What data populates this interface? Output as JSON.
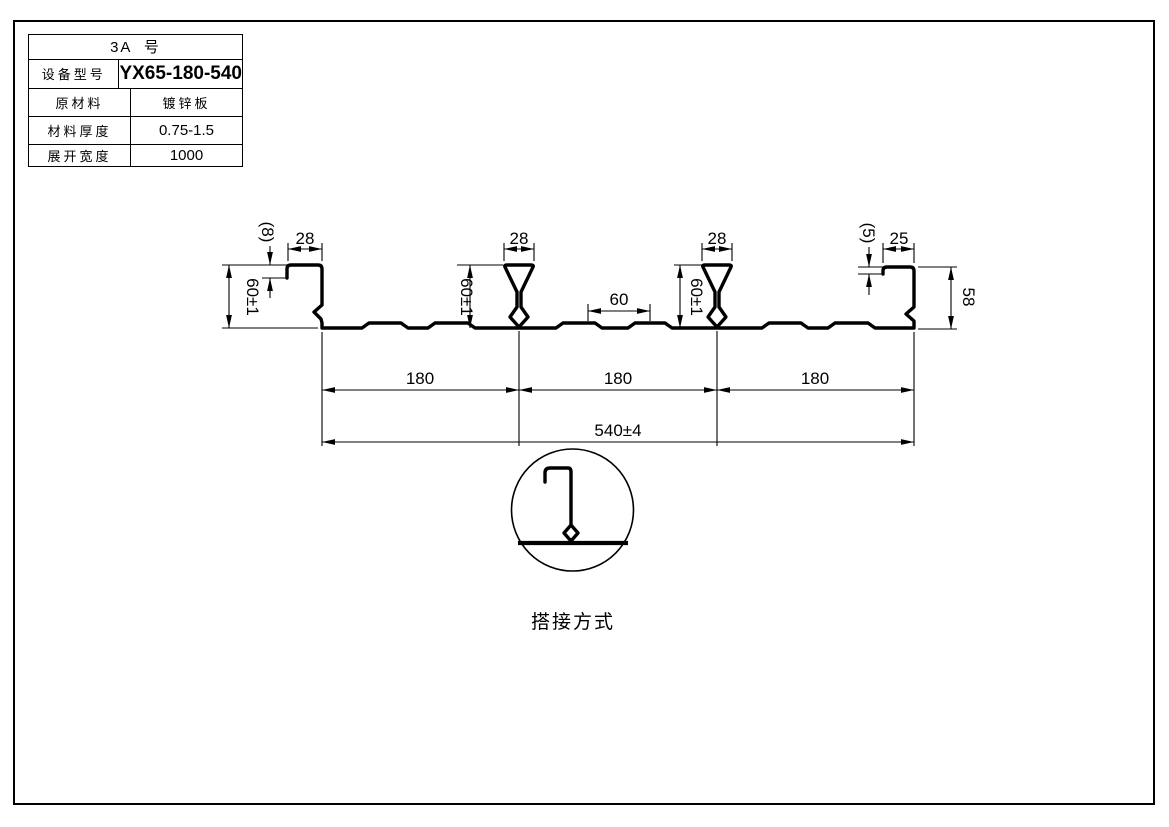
{
  "spec_table": {
    "title": "3A  号",
    "rows": [
      {
        "label": "设备型号",
        "value": "YX65-180-540"
      },
      {
        "label": "原材料",
        "value": "镀锌板"
      },
      {
        "label": "材料厚度",
        "value": "0.75-1.5"
      },
      {
        "label": "展开宽度",
        "value": "1000"
      }
    ]
  },
  "drawing": {
    "dimensions": {
      "left_lip_width": "28",
      "left_lip_return": "(8)",
      "left_height": "60±1",
      "rib1_top_width": "28",
      "rib1_height": "60±1",
      "mid_groove_spacing": "60",
      "rib2_top_width": "28",
      "rib2_height": "60±1",
      "right_lip_return": "(5)",
      "right_lip_width": "25",
      "right_height": "58",
      "module1": "180",
      "module2": "180",
      "module3": "180",
      "overall_width": "540±4"
    },
    "detail_caption": "搭接方式"
  }
}
